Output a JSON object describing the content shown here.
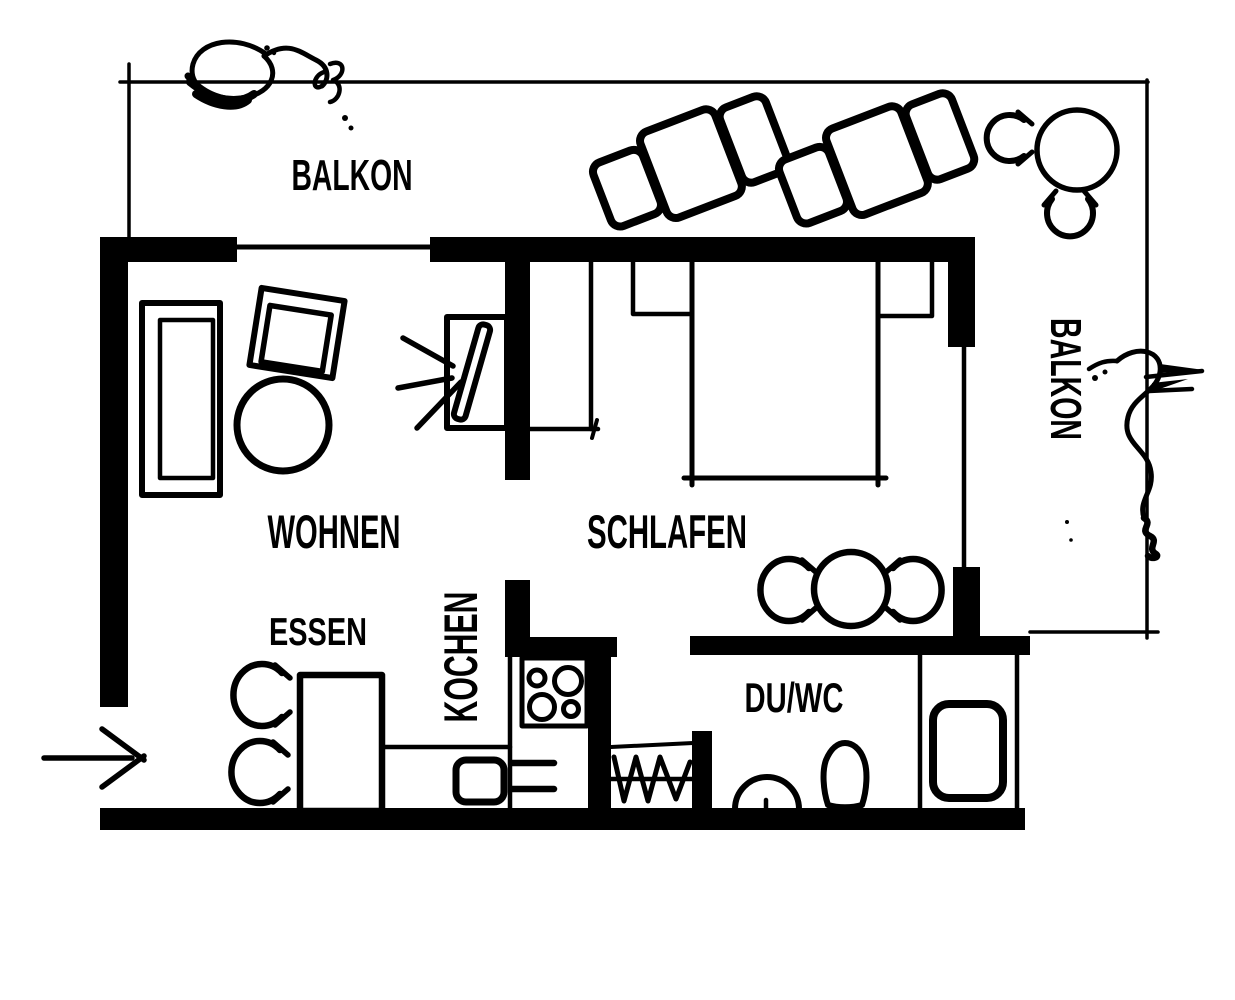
{
  "floorplan": {
    "colors": {
      "ink": "#000000",
      "background": "#ffffff"
    },
    "labels": {
      "balkon_top": "BALKON",
      "balkon_right": "BALKON",
      "wohnen": "WOHNEN",
      "schlafen": "SCHLAFEN",
      "essen": "ESSEN",
      "kochen": "KOCHEN",
      "du_wc": "DU/WC"
    }
  }
}
